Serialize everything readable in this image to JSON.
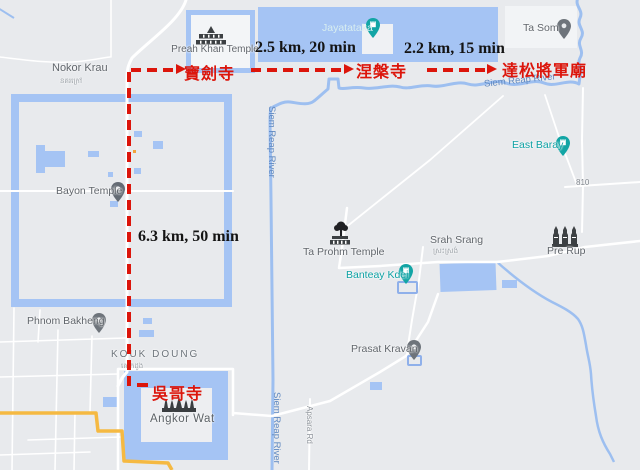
{
  "route": {
    "color": "#dc150b",
    "distance_labels": [
      {
        "text": "2.5 km, 20 min"
      },
      {
        "text": "2.2 km, 15 min"
      },
      {
        "text": "6.3 km, 50 min"
      }
    ],
    "stop_labels": {
      "preah_khan": "寶劍寺",
      "neak_pean": "涅槃寺",
      "ta_som": "達松將軍廟",
      "angkor_wat": "吳哥寺"
    }
  },
  "map": {
    "labels": {
      "preah_khan_temple": "Preah Khan Temple",
      "nokor_krau": "Nokor Krau",
      "nokor_krau_khmer": "នគរក្រៅ",
      "jayatataka": "Jayatataka",
      "ta_som": "Ta Som",
      "siem_reap_river": "Siem Reap River",
      "east_baray": "East Baray",
      "route_810": "810",
      "bayon_temple": "Bayon Temple",
      "ta_prohm_temple": "Ta Prohm Temple",
      "srah_srang": "Srah Srang",
      "srah_srang_khmer": "ស្រះស្រង់",
      "pre_rup": "Pre Rup",
      "banteay_kdei": "Banteay Kdei",
      "phnom_bakheng": "Phnom Bakheng",
      "kouk_doung": "KOUK DOUNG",
      "kouk_doung_khmer": "គោកដូង",
      "prasat_kravan": "Prasat Kravan",
      "angkor_wat": "Angkor Wat",
      "apsara_rd": "Apsara Rd"
    },
    "icons": {
      "gray_pin": "map-pin",
      "teal_pin": "attraction-pin",
      "preah_khan": "temple-gate-icon",
      "angkor_wat": "angkor-wat-towers-icon",
      "ta_prohm": "tree-temple-icon",
      "pre_rup": "three-towers-icon"
    },
    "colors": {
      "background": "#e8eaed",
      "water": "#a5c4f4",
      "road": "#ffffff",
      "highway_orange": "#f5b942",
      "poi_label_gray": "#61666c",
      "khmer_label_gray": "#9aa0a6",
      "water_label_blue": "#5f88c0",
      "poi_teal": "#0da1a4",
      "annotation_red": "#dc150b",
      "annotation_black": "#141414",
      "temple_icon_dark": "#3c4043"
    }
  }
}
